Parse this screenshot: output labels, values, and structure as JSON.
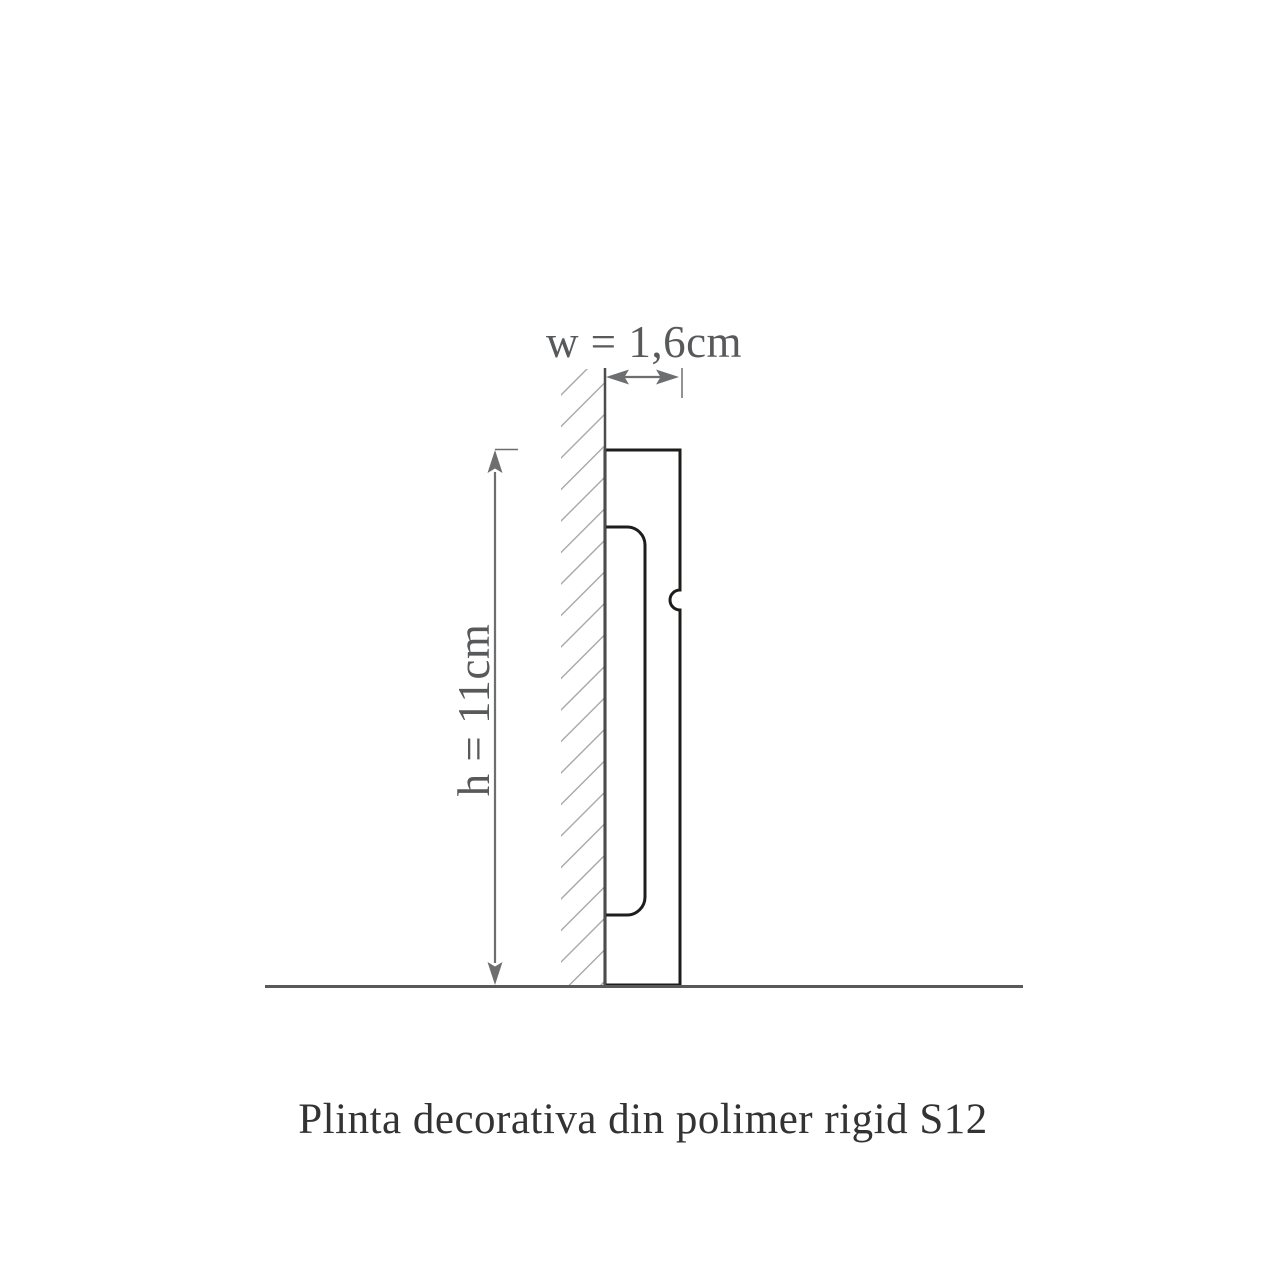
{
  "diagram": {
    "title_caption": "Plinta decorativa din polimer rigid S12",
    "width_dimension": {
      "label": "w = 1,6cm",
      "value": "1,6cm"
    },
    "height_dimension": {
      "label": "h = 11cm",
      "value": "11cm"
    }
  },
  "colors": {
    "background": "#ffffff",
    "profile_outline": "#1d1d1b",
    "wall_line": "#4c4c4e",
    "hatch_lines": "#a7a9ac",
    "dimension_lines": "#6d6e70",
    "floor_line": "#58595b",
    "dimension_text": "#58595b",
    "caption_text": "#333333"
  }
}
